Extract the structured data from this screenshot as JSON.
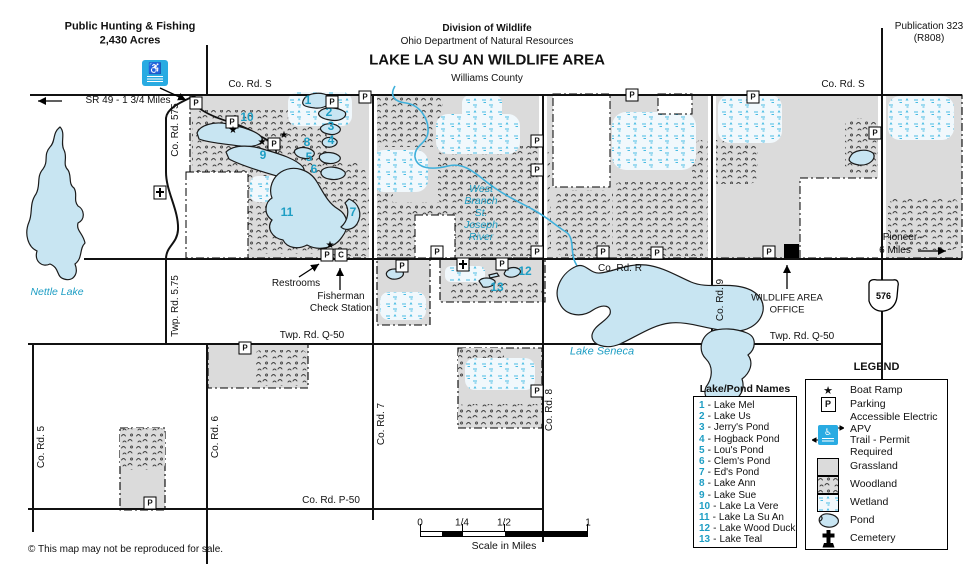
{
  "header": {
    "hunting_line1": "Public Hunting & Fishing",
    "hunting_line2": "2,430 Acres",
    "division": "Division of Wildlife",
    "department": "Ohio Department of Natural Resources",
    "title": "LAKE LA SU AN WILDLIFE AREA",
    "county": "Williams County",
    "publication_line1": "Publication 323",
    "publication_line2": "(R808)"
  },
  "roads": {
    "co_rd_s": "Co. Rd. S",
    "sr49_arrow": "SR 49 - 1 3/4 Miles",
    "co_rd_575": "Co. Rd. 575",
    "twp_rd_5_75": "Twp. Rd. 5.75",
    "co_rd_5": "Co. Rd. 5",
    "co_rd_6": "Co. Rd. 6",
    "co_rd_7": "Co. Rd. 7",
    "co_rd_8": "Co. Rd. 8",
    "co_rd_9": "Co. Rd. 9",
    "co_rd_r": "Co. Rd. R",
    "twp_rd_q50": "Twp. Rd. Q-50",
    "co_rd_p50": "Co. Rd. P-50",
    "sr_576": "576",
    "pioneer_line1": "Pioneer -",
    "pioneer_line2": "6 Miles"
  },
  "water": {
    "nettle_lake": "Nettle Lake",
    "lake_seneca": "Lake Seneca",
    "river_line1": "West",
    "river_line2": "Branch",
    "river_line3": "St.",
    "river_line4": "Joseph",
    "river_line5": "River"
  },
  "facilities": {
    "restrooms": "Restrooms",
    "check_line1": "Fisherman",
    "check_line2": "Check Station",
    "office_line1": "WILDLIFE AREA",
    "office_line2": "OFFICE"
  },
  "markers": {
    "parking": "P",
    "check": "C",
    "boat_ramp": "★",
    "apv_glyph": "♿"
  },
  "pond_list": {
    "title": "Lake/Pond Names",
    "sep": "-",
    "items": [
      {
        "num": "1",
        "name": "Lake Mel"
      },
      {
        "num": "2",
        "name": "Lake Us"
      },
      {
        "num": "3",
        "name": "Jerry's Pond"
      },
      {
        "num": "4",
        "name": "Hogback Pond"
      },
      {
        "num": "5",
        "name": "Lou's Pond"
      },
      {
        "num": "6",
        "name": "Clem's Pond"
      },
      {
        "num": "7",
        "name": "Ed's Pond"
      },
      {
        "num": "8",
        "name": "Lake Ann"
      },
      {
        "num": "9",
        "name": "Lake Sue"
      },
      {
        "num": "10",
        "name": "Lake La Vere"
      },
      {
        "num": "11",
        "name": "Lake La Su An"
      },
      {
        "num": "12",
        "name": "Lake Wood Duck"
      },
      {
        "num": "13",
        "name": "Lake Teal"
      }
    ]
  },
  "legend": {
    "title": "LEGEND",
    "boat_ramp": "Boat Ramp",
    "parking": "Parking",
    "apv_line1": "Accessible Electric APV",
    "apv_line2": "Trail - Permit Required",
    "grassland": "Grassland",
    "woodland": "Woodland",
    "wetland": "Wetland",
    "pond": "Pond",
    "cemetery": "Cemetery"
  },
  "scale_bar": {
    "t0": "0",
    "tq": "1/4",
    "th": "1/2",
    "t1": "1",
    "caption": "Scale in Miles"
  },
  "footer": {
    "copyright": "© This map may not be reproduced for sale."
  },
  "colors": {
    "cyan_label": "#1E9EC4",
    "lake_fill": "#C8E5F2",
    "grassland": "#DBDBDB",
    "apv_sign": "#29ABE2",
    "river": "#3FB0DB"
  }
}
